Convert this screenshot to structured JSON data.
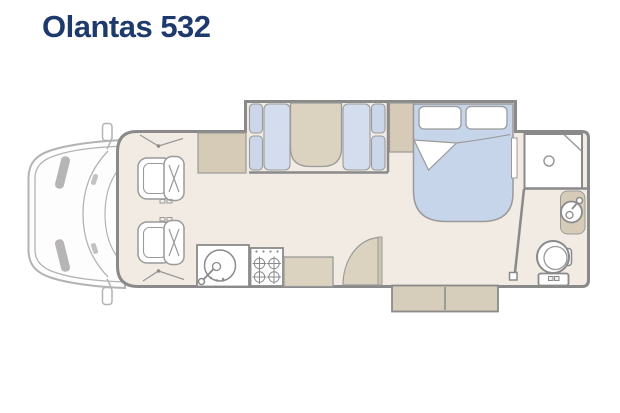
{
  "header": {
    "title": "Olantas 532"
  },
  "colors": {
    "title": "#1e3a6c",
    "floor": "#f1ebe3",
    "wall": "#8a8a8a",
    "outline": "#9a9a9a",
    "cushion": "#cbd6e9",
    "seat": "#d4ddee",
    "bed": "#c7d5ea",
    "table": "#dbd2bf",
    "cabinet": "#d5cbb6",
    "step": "#d6cdba",
    "doorleaf": "#cfc5ae",
    "cabline": "#b4b2b2",
    "headlight": "#a9a7a7",
    "white": "#ffffff"
  },
  "floorplan": {
    "model": "Olantas 532",
    "view": "top-down motorhome floor plan",
    "fixtures": [
      "cab",
      "side-mirror",
      "side-mirror",
      "headlight",
      "headlight",
      "swivel-seat-front",
      "swivel-seat-rear",
      "overhead-cabinet",
      "dinette-bench-left",
      "dinette-table",
      "dinette-bench-right",
      "wardrobe",
      "double-bed",
      "pillow",
      "pillow",
      "bedside-shelf",
      "kitchen-sink",
      "gas-hob",
      "kitchen-counter",
      "entry-door",
      "entry-step",
      "shower",
      "washbasin",
      "vanity",
      "toilet"
    ]
  }
}
